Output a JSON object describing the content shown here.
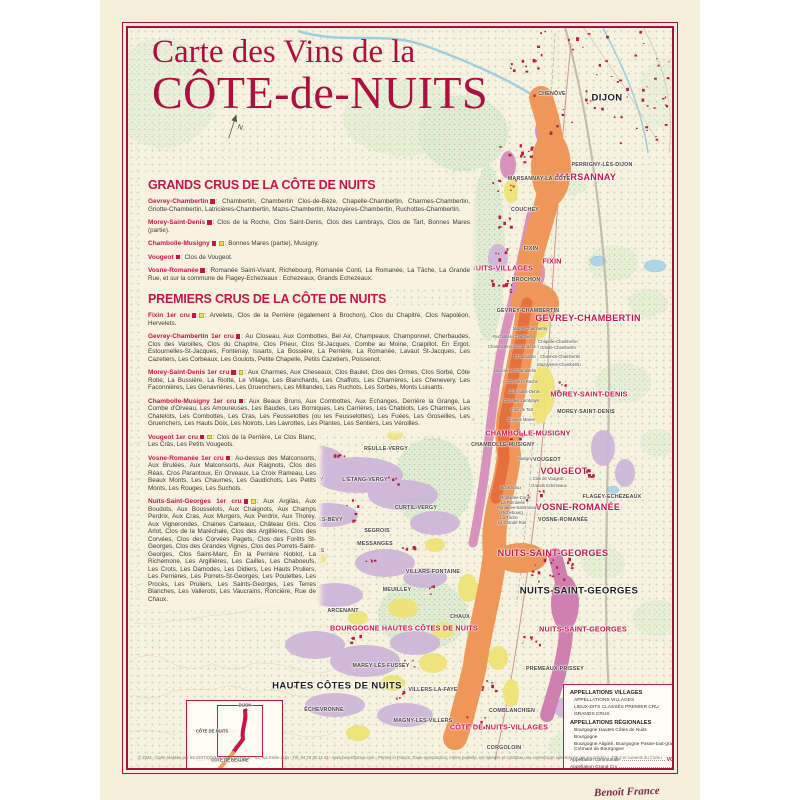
{
  "poster": {
    "title_line1": "Carte des Vins de la",
    "title_line2": "CÔTE-de-NUITS",
    "copyright": "© 2024 - Carte réalisée par les EDITIONS BENOIT FRANCE - 41, rue Emile Zola - Tél. 04 78 39 14 43 - www.benoitfrance.com - Printed in France. Toute reproduction, même partielle, est interdite et constitue une contrefaçon sanctionnée par les articles L.335-2 et suivants du Code de la Propriété Intellectuelle.",
    "signature": "Benoît France"
  },
  "panel": {
    "grands_header": "GRANDS CRUS DE LA CÔTE DE NUITS",
    "premiers_header": "PREMIERS CRUS DE LA CÔTE DE NUITS",
    "grands": [
      {
        "name": "Gevrey-Chambertin",
        "marks": "r",
        "text": ": Chambertin, Chambertin Clos-de-Bèze, Chapelle-Chambertin, Charmes-Chambertin, Griotte-Chambertin, Latricières-Chambertin, Mazis-Chambertin, Mazoyères-Chambertin, Ruchottes-Chambertin."
      },
      {
        "name": "Morey-Saint-Denis",
        "marks": "r",
        "text": ": Clos de la Roche, Clos Saint-Denis, Clos des Lambrays, Clos de Tart, Bonnes Mares (partie)."
      },
      {
        "name": "Chambolle-Musigny",
        "marks": "ry",
        "text": ": Bonnes Mares (partie), Musigny."
      },
      {
        "name": "Vougeot",
        "marks": "r",
        "text": ": Clos de Vougeot."
      },
      {
        "name": "Vosne-Romanée",
        "marks": "r",
        "text": ": Romanée Saint-Vivant, Richebourg, Romanée Conti, La Romanée, La Tâche, La Grande Rue, et sur la commune de Flagey-Echezeaux : Echezeaux, Grands Echezeaux."
      }
    ],
    "premiers_wide": [
      {
        "name": "Fixin 1er cru",
        "marks": "ry",
        "text": ": Arvelets, Clos de la Perrière (également à Brochon), Clos du Chapitre, Clos Napoléon, Hervelets."
      },
      {
        "name": "Gevrey-Chambertin 1er cru",
        "marks": "r",
        "text": ": Au Closeau, Aux Combottes, Bel Air, Champeaux, Champonnet, Cherbaudes, Clos des Varoilles, Clos du Chapitre, Clos Prieur, Clos St-Jacques, Combe au Moine, Craipillot, En Ergot, Estournelles-St-Jacques, Fontenay, Issarts, La Bossière, La Perrière, La Romanée, Lavaut St-Jacques, Les Cazetiers, Les Corbeaux, Les Goulots, Petite Chapelle, Petits Cazetiers, Poissenot."
      },
      {
        "name": "Morey-Saint-Denis 1er cru",
        "marks": "ry",
        "text": ": Aux Charmes, Aux Cheseaux, Clos Baulet, Clos des Ormes, Clos Sorbé, Côte Rotie, La Bussière, La Riotte, Le Village, Les Blanchards, Les Chaffots, Les Charrières, Les Chenevery, Les Faconnières, Les Genavrières, Les Gruenchers, Les Millandes, Les Ruchots, Les Sorbés, Monts Luisants."
      },
      {
        "name": "Chambolle-Musigny 1er cru",
        "marks": "r",
        "text": ": Aux Beaux Bruns, Aux Combottes, Aux Echanges, Derrière la Grange, La Combe d'Orveau, Les Amoureuses, Les Baudes, Les Borniques, Les Carrières, Les Chabiots, Les Charmes, Les Chatelots, Les Combottes, Les Cras, Les Feusselottes (ou les Feusselottes), Les Fuées, Les Groseilles, Les Gruenchers, Les Hauts Doix, Les Noirots, Les Lavrottes, Les Plantes, Les Sentiers, Les Véroilles."
      }
    ],
    "premiers_narrow": [
      {
        "name": "Vougeot 1er cru",
        "marks": "ry",
        "text": ": Clos de la Perrière, Le Clos Blanc, Les Crâs, Les Petits Vougeots."
      },
      {
        "name": "Vosne-Romanée 1er cru",
        "marks": "r",
        "text": ": Au-dessus des Malconsorts, Aux Brulées, Aux Malconsorts, Aux Raignots, Clos des Réas, Cros Parantoux, En Orveaux, La Croix Rameau, Les Beaux Monts, Les Chaumes, Les Gaudichots, Les Petits Monts, Les Rouges, Les Suchots."
      },
      {
        "name": "Nuits-Saint-Georges 1er cru",
        "marks": "ry",
        "text": ": Aux Argilas, Aux Boudots, Aux Bousselots, Aux Chaignots, Aux Champs Perdrix, Aux Cras, Aux Murgers, Aux Perdrix, Aux Thorey, Aux Vignerondes, Chaines Carteaux, Château Gris, Clos Arlot, Clos de la Maréchale, Clos des Argillières, Clos des Corvées, Clos des Corvées Pagets, Clos des Forêts St-Georges, Clos des Grandes Vignes, Clos des Porrets-Saint-Georges, Clos Saint-Marc, En la Perrière Noblot, La Richemone, Les Argillières, Les Cailles, Les Chaboeufs, Les Crots, Les Damodes, Les Didiers, Les Hauts Pruliers, Les Perrières, Les Porrets-St-Georges, Les Poulettes, Les Procès, Les Pruliers, Les Saints-Georges, Les Terres Blanches, Les Vallerots, Les Vaucrains, Roncière, Rue de Chaux."
      }
    ]
  },
  "map": {
    "labels": [
      {
        "t": "MARSANNAY",
        "x": 458,
        "y": 149,
        "c": "rb"
      },
      {
        "t": "CÔTE DE NUITS-VILLAGES",
        "x": 356,
        "y": 240,
        "c": "rm"
      },
      {
        "t": "FIXIN",
        "x": 424,
        "y": 233,
        "c": "rm"
      },
      {
        "t": "GEVREY-CHAMBERTIN",
        "x": 460,
        "y": 290,
        "c": "rb"
      },
      {
        "t": "MOREY-SAINT-DENIS",
        "x": 461,
        "y": 366,
        "c": "rm"
      },
      {
        "t": "CHAMBOLLE-MUSIGNY",
        "x": 400,
        "y": 405,
        "c": "rm"
      },
      {
        "t": "VOUGEOT",
        "x": 436,
        "y": 443,
        "c": "rb"
      },
      {
        "t": "VOSNE-ROMANÉE",
        "x": 450,
        "y": 479,
        "c": "rb"
      },
      {
        "t": "NUITS-SAINT-GEORGES",
        "x": 425,
        "y": 525,
        "c": "rb"
      },
      {
        "t": "NUITS-SAINT-GEORGES",
        "x": 455,
        "y": 601,
        "c": "rm"
      },
      {
        "t": "BOURGOGNE HAUTES CÔTES DE NUITS",
        "x": 276,
        "y": 600,
        "c": "rm"
      },
      {
        "t": "CÔTE DE NUITS-VILLAGES",
        "x": 371,
        "y": 699,
        "c": "rm"
      },
      {
        "t": "DIJON",
        "x": 479,
        "y": 70,
        "c": "bb"
      },
      {
        "t": "NUITS-SAINT-GEORGES",
        "x": 451,
        "y": 563,
        "c": "bb"
      },
      {
        "t": "HAUTES CÔTES DE NUITS",
        "x": 209,
        "y": 658,
        "c": "bb"
      },
      {
        "t": "CÔTE DE BEAUNE",
        "x": 275,
        "y": 746,
        "c": "it"
      },
      {
        "t": "CHENÔVE",
        "x": 424,
        "y": 66,
        "c": "bt"
      },
      {
        "t": "PERRIGNY-LÈS-DIJON",
        "x": 474,
        "y": 137,
        "c": "bt"
      },
      {
        "t": "MARSANNAY-LA-CÔTE",
        "x": 411,
        "y": 151,
        "c": "bt"
      },
      {
        "t": "COUCHEY",
        "x": 397,
        "y": 182,
        "c": "bt"
      },
      {
        "t": "FIXIN",
        "x": 403,
        "y": 221,
        "c": "bt"
      },
      {
        "t": "BROCHON",
        "x": 398,
        "y": 252,
        "c": "bt"
      },
      {
        "t": "GEVREY-CHAMBERTIN",
        "x": 400,
        "y": 283,
        "c": "bt"
      },
      {
        "t": "MOREY-SAINT-DENIS",
        "x": 458,
        "y": 384,
        "c": "bt"
      },
      {
        "t": "CHAMBOLLE-MUSIGNY",
        "x": 375,
        "y": 417,
        "c": "bt"
      },
      {
        "t": "VOUGEOT",
        "x": 419,
        "y": 432,
        "c": "bt"
      },
      {
        "t": "FLAGEY-ECHÉZEAUX",
        "x": 484,
        "y": 469,
        "c": "bt"
      },
      {
        "t": "VOSNE-ROMANÉE",
        "x": 435,
        "y": 492,
        "c": "bt"
      },
      {
        "t": "PREMEAUX-PRISSEY",
        "x": 427,
        "y": 641,
        "c": "bt"
      },
      {
        "t": "COMBLANCHIEN",
        "x": 384,
        "y": 683,
        "c": "bt"
      },
      {
        "t": "CORGOLOIN",
        "x": 376,
        "y": 720,
        "c": "bt"
      },
      {
        "t": "REULLE-VERGY",
        "x": 258,
        "y": 421,
        "c": "bt"
      },
      {
        "t": "BÉVY",
        "x": 188,
        "y": 452,
        "c": "bt"
      },
      {
        "t": "L'ÉTANG-VERGY",
        "x": 237,
        "y": 452,
        "c": "bt"
      },
      {
        "t": "CURTIL-VERGY",
        "x": 288,
        "y": 480,
        "c": "bt"
      },
      {
        "t": "COLLONGES-LÈS-BÉVY",
        "x": 182,
        "y": 492,
        "c": "bt"
      },
      {
        "t": "SEGROIS",
        "x": 249,
        "y": 503,
        "c": "bt"
      },
      {
        "t": "MESSANGES",
        "x": 247,
        "y": 516,
        "c": "bt"
      },
      {
        "t": "CHEVANNES",
        "x": 179,
        "y": 523,
        "c": "bt"
      },
      {
        "t": "VILLARS-FONTAINE",
        "x": 305,
        "y": 544,
        "c": "bt"
      },
      {
        "t": "MEUILLEY",
        "x": 269,
        "y": 562,
        "c": "bt"
      },
      {
        "t": "ARCENANT",
        "x": 215,
        "y": 583,
        "c": "bt"
      },
      {
        "t": "CHAUX",
        "x": 332,
        "y": 589,
        "c": "bt"
      },
      {
        "t": "MAREY-LÈS-FUSSEY",
        "x": 253,
        "y": 638,
        "c": "bt"
      },
      {
        "t": "VILLERS-LA-FAYE",
        "x": 305,
        "y": 662,
        "c": "bt"
      },
      {
        "t": "MAGNY-LES-VILLERS",
        "x": 295,
        "y": 693,
        "c": "bt"
      },
      {
        "t": "ÉCHEVRONNE",
        "x": 196,
        "y": 682,
        "c": "bt"
      },
      {
        "t": "Mazis-Chambertin",
        "x": 402,
        "y": 301,
        "c": "td"
      },
      {
        "t": "Ruchottes-Chambertin",
        "x": 386,
        "y": 309,
        "c": "td"
      },
      {
        "t": "Chapelle-Chambertin",
        "x": 430,
        "y": 314,
        "c": "td"
      },
      {
        "t": "Chambertin-Clos de Bèze",
        "x": 384,
        "y": 319,
        "c": "td"
      },
      {
        "t": "Griotte-Chambertin",
        "x": 430,
        "y": 320,
        "c": "td"
      },
      {
        "t": "Chambertin",
        "x": 397,
        "y": 329,
        "c": "td"
      },
      {
        "t": "Charmes-Chambertin",
        "x": 432,
        "y": 329,
        "c": "td"
      },
      {
        "t": "Mazoyères-Chambertin",
        "x": 431,
        "y": 337,
        "c": "td"
      },
      {
        "t": "Latricières-Chambertin",
        "x": 387,
        "y": 343,
        "c": "td"
      },
      {
        "t": "Clos de la Roche",
        "x": 394,
        "y": 354,
        "c": "td"
      },
      {
        "t": "Clos Saint-Denis",
        "x": 396,
        "y": 364,
        "c": "td"
      },
      {
        "t": "Clos des Lambrays",
        "x": 393,
        "y": 373,
        "c": "td"
      },
      {
        "t": "Clos de Tart",
        "x": 394,
        "y": 382,
        "c": "td"
      },
      {
        "t": "Bonnes Mares",
        "x": 393,
        "y": 392,
        "c": "td"
      },
      {
        "t": "Musigny",
        "x": 397,
        "y": 431,
        "c": "td"
      },
      {
        "t": "Clos de Vougeot",
        "x": 420,
        "y": 451,
        "c": "td"
      },
      {
        "t": "Grands Echézeaux",
        "x": 421,
        "y": 458,
        "c": "td"
      },
      {
        "t": "Echézeaux",
        "x": 383,
        "y": 460,
        "c": "td"
      },
      {
        "t": "Romanée-Conti",
        "x": 387,
        "y": 470,
        "c": "td"
      },
      {
        "t": "La Romanée",
        "x": 385,
        "y": 475,
        "c": "td"
      },
      {
        "t": "Romanée-Saint-Vivant",
        "x": 390,
        "y": 480,
        "c": "td"
      },
      {
        "t": "Richebourg",
        "x": 384,
        "y": 485,
        "c": "td"
      },
      {
        "t": "La Tâche",
        "x": 381,
        "y": 490,
        "c": "td"
      },
      {
        "t": "La Grande Rue",
        "x": 384,
        "y": 495,
        "c": "td"
      },
      {
        "t": "DIJON",
        "x": 117,
        "y": 677,
        "c": "il"
      },
      {
        "t": "CÔTE DE NUITS",
        "x": 84,
        "y": 703,
        "c": "il"
      },
      {
        "t": "CÔTE DE BEAUNE",
        "x": 102,
        "y": 732,
        "c": "il"
      }
    ],
    "compass": "N"
  },
  "legend": {
    "villages_title": "APPELLATIONS VILLAGES",
    "villages_items": [
      {
        "label": "APPELLATIONS VILLAGES",
        "color": "#ec9c66"
      },
      {
        "label": "LIEUX-DITS CLASSÉS PREMIER CRU",
        "color": "#dc9ec4"
      },
      {
        "label": "GRANDS CRUS",
        "color": "#e06a38"
      }
    ],
    "regionales_title": "APPELLATIONS RÉGIONALES",
    "regionales_items": [
      {
        "label": "Bourgogne Hautes Côtes de Nuits",
        "color": "#d9c8e6"
      },
      {
        "label": "Bourgogne",
        "color": "#e3dcec"
      },
      {
        "label": "Bourgogne Aligoté, Bourgogne Passe-tout-grains, Crémant de Bourgogne",
        "color": "#f2ea85"
      }
    ],
    "footer_rows": [
      {
        "label": "Appellation communale",
        "value": "VOSNE-ROMANÉE",
        "c": "red-val"
      },
      {
        "label": "Appellation Grand Cru",
        "value": "Richebourg",
        "c": ""
      },
      {
        "label": "Commune viticole",
        "value": "VOSNE-ROMANÉE",
        "c": ""
      }
    ]
  },
  "colors": {
    "accent_red": "#c3164a",
    "villages_orange": "#ef9659",
    "grand_cru_orange": "#e4703d",
    "premier_cru_pink": "#d893bd",
    "hautes_cotes_purple": "#cdb3da",
    "regional_yellow": "#efe276",
    "poster_cream": "#f6efda"
  }
}
